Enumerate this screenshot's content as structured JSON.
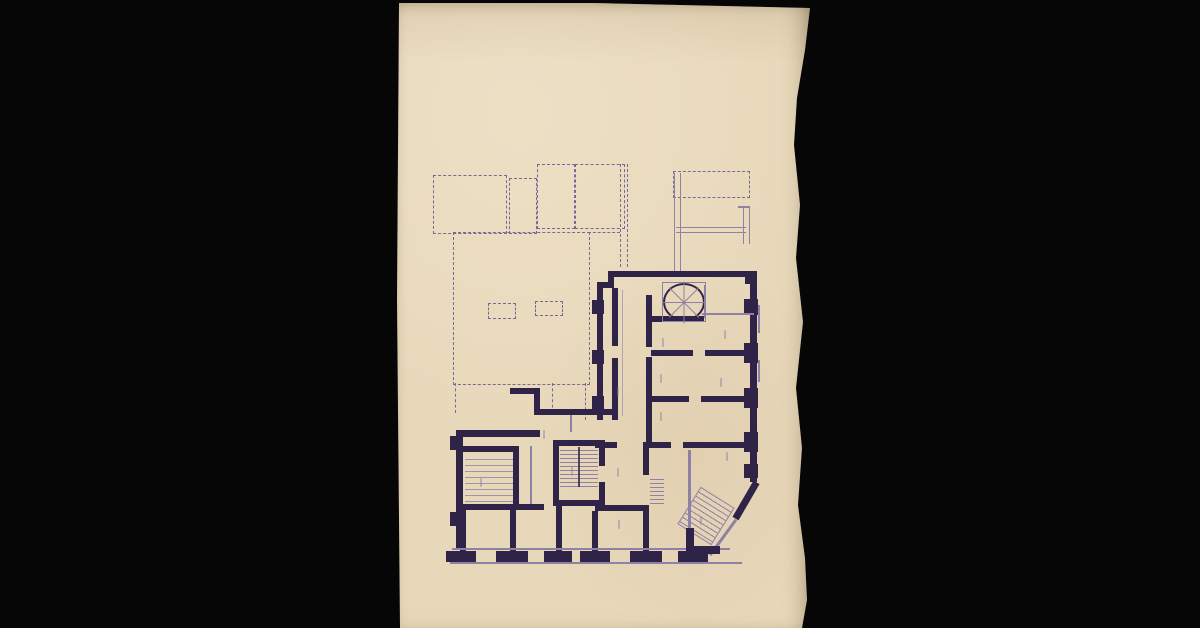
{
  "page": {
    "background_color": "#060606",
    "paper_color": "#e8d8ba",
    "ink_heavy_color": "#2f2448",
    "ink_light_color": "#8f81a6",
    "ink_dashed_color": "#77689a"
  },
  "drawing": {
    "title": "PIANO TERRA",
    "scale": "1:100"
  }
}
